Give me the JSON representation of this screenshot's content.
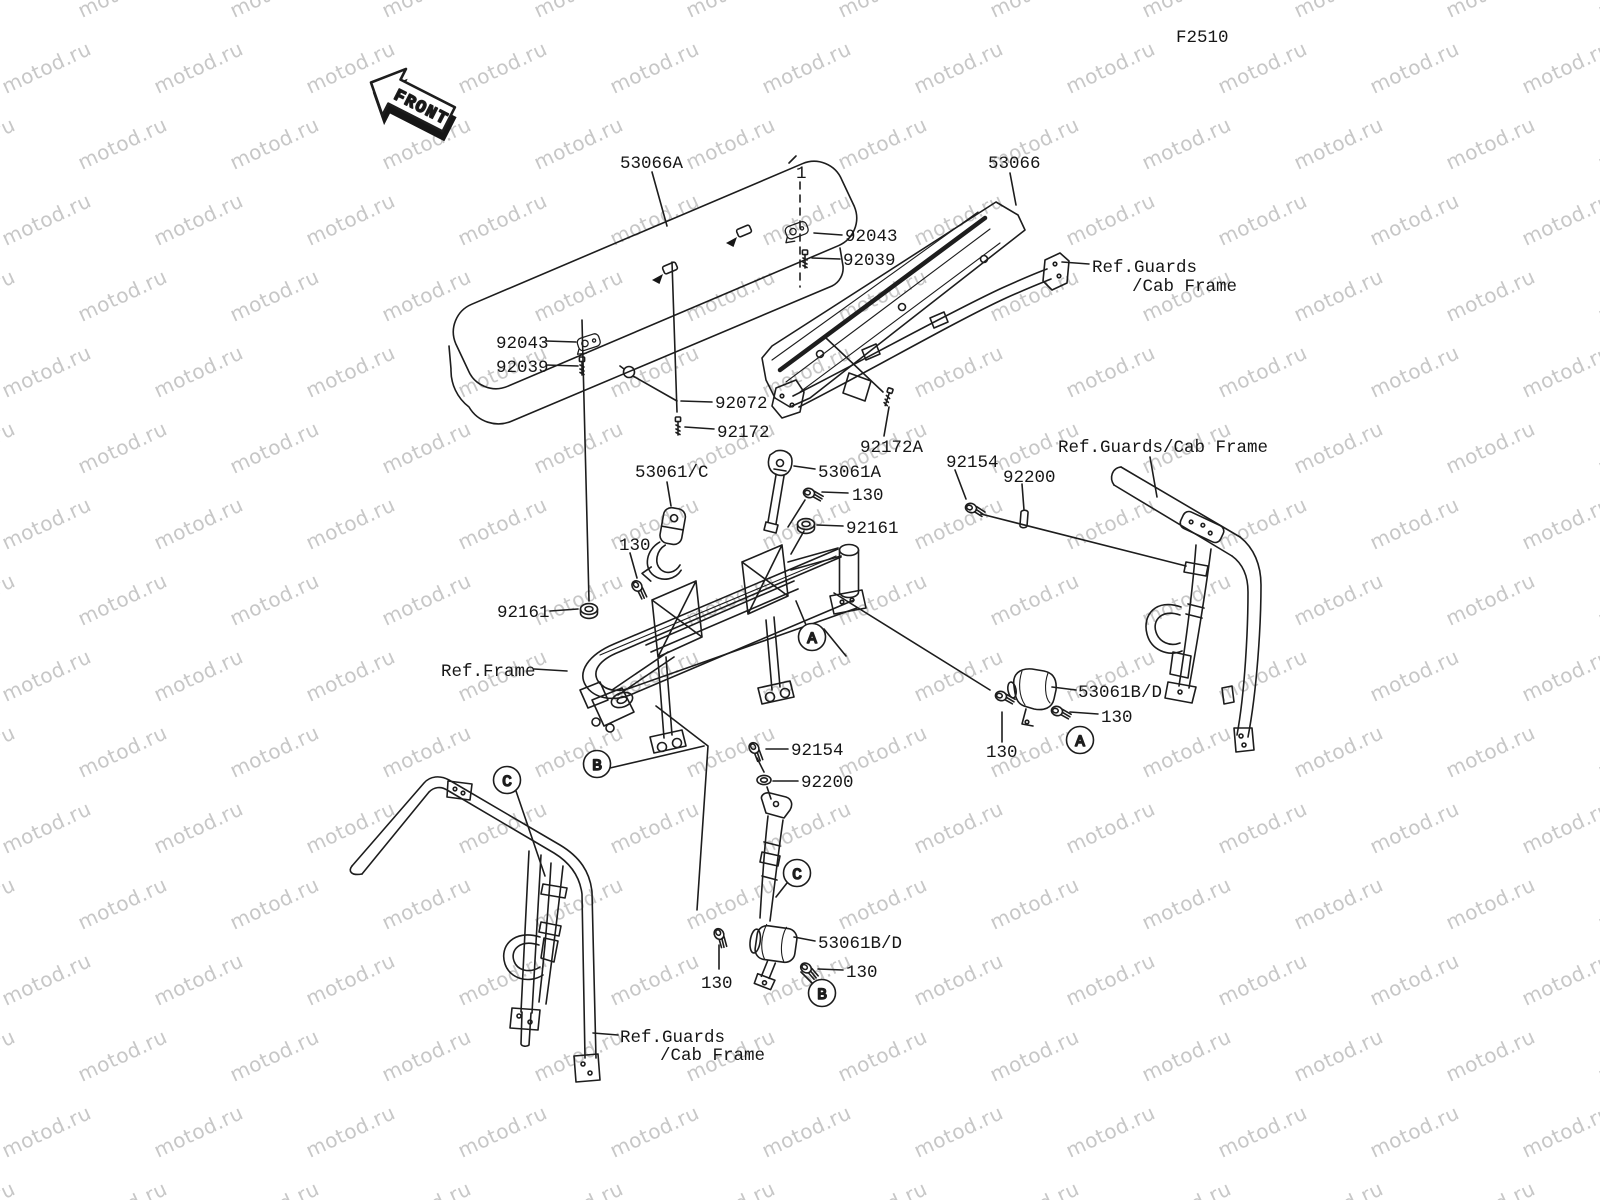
{
  "figure": {
    "code": "F2510",
    "front": "FRONT",
    "watermark": "motod.ru"
  },
  "callouts": {
    "a": "A",
    "b": "B",
    "c": "C"
  },
  "part_labels": {
    "seat_bottom": "53066A",
    "seat_back": "53066",
    "item1": "1",
    "clamp": "92043",
    "pin": "92039",
    "hook": "92072",
    "screw": "92172",
    "screw_a": "92172A",
    "belt_front": "53061/C",
    "belt_a": "53061A",
    "bolt": "130",
    "nut": "92161",
    "shoulder_bolt": "92154",
    "collar": "92200",
    "belt_rear": "53061B/D",
    "ref_frame": "Ref.Frame",
    "ref_guards_line1": "Ref.Guards",
    "ref_guards_line2": "/Cab Frame",
    "ref_guards_full": "Ref.Guards/Cab Frame"
  }
}
